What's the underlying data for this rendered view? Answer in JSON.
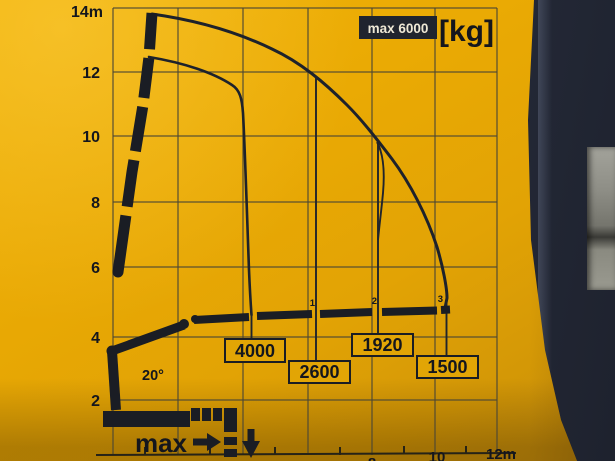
{
  "chart_data": {
    "type": "line",
    "title": "max 6000 [kg]",
    "max_capacity_label": "max 6000",
    "unit_label": "[kg]",
    "max_load_kg": 6000,
    "boom_angle_label": "20°",
    "pictogram_label": "max",
    "y_ticks": [
      "14m",
      "12",
      "10",
      "8",
      "6",
      "4",
      "2"
    ],
    "x_ticks": [
      "8",
      "10",
      "12m"
    ],
    "extension_markers": [
      "1",
      "2",
      "3"
    ],
    "capacities": [
      {
        "marker": "",
        "reach_m": 4.3,
        "load_kg": "4000"
      },
      {
        "marker": "1",
        "reach_m": 6.3,
        "load_kg": "2600"
      },
      {
        "marker": "2",
        "reach_m": 8.2,
        "load_kg": "1920"
      },
      {
        "marker": "3",
        "reach_m": 10.3,
        "load_kg": "1500"
      }
    ],
    "curves": [
      {
        "name": "envelope-full-boom",
        "points_m": [
          [
            1.2,
            13.9
          ],
          [
            3.0,
            13.4
          ],
          [
            5.0,
            12.5
          ],
          [
            6.3,
            11.9
          ],
          [
            7.3,
            10.9
          ],
          [
            8.2,
            9.8
          ],
          [
            9.0,
            8.4
          ],
          [
            9.8,
            6.4
          ],
          [
            10.3,
            4.9
          ]
        ]
      },
      {
        "name": "envelope-short-boom",
        "points_m": [
          [
            1.1,
            12.5
          ],
          [
            2.4,
            12.1
          ],
          [
            3.7,
            11.5
          ],
          [
            4.0,
            10.9
          ],
          [
            4.2,
            7.6
          ],
          [
            4.3,
            4.6
          ]
        ]
      }
    ],
    "axes": {
      "x_unit": "m",
      "y_unit": "m",
      "x_range": [
        0,
        12
      ],
      "y_range": [
        0,
        14
      ],
      "grid_step_m": 2,
      "grid": true
    }
  },
  "colors": {
    "plate_yellow": "#e8aa04",
    "ink": "#1a1d24",
    "badge_bg": "#20242e",
    "badge_text": "#eee8d6",
    "machine_dark": "#2b3141",
    "concrete_gray": "#8e8e86"
  }
}
